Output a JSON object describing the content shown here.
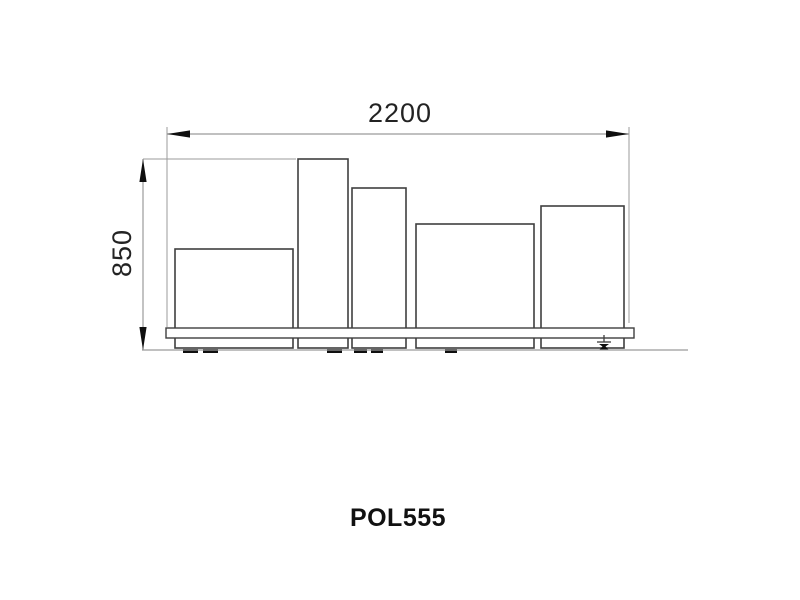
{
  "product": {
    "code": "POL555"
  },
  "dimensions": {
    "width": {
      "label": "2200"
    },
    "height": {
      "label": "850"
    }
  },
  "colors": {
    "background": "#ffffff",
    "dim_line": "#9b9b9b",
    "outline": "#3f3f3f",
    "arrow": "#0f0f0f",
    "dim_text": "#232323",
    "code_text": "#111111"
  },
  "geometry": {
    "modules": [
      {
        "x": 175,
        "y": 249,
        "w": 118,
        "h": 99
      },
      {
        "x": 298,
        "y": 159,
        "w": 50,
        "h": 189
      },
      {
        "x": 352,
        "y": 188,
        "w": 54,
        "h": 160
      },
      {
        "x": 416,
        "y": 224,
        "w": 118,
        "h": 124
      },
      {
        "x": 541,
        "y": 206,
        "w": 83,
        "h": 142
      }
    ],
    "plinth": {
      "x": 166,
      "y": 328,
      "w": 468,
      "h": 10
    },
    "ground": {
      "x1": 142,
      "x2": 688,
      "y": 350
    },
    "feet": [
      {
        "x": 183,
        "w": 15
      },
      {
        "x": 203,
        "w": 15
      },
      {
        "x": 327,
        "w": 15
      },
      {
        "x": 354,
        "w": 13
      },
      {
        "x": 371,
        "w": 12
      },
      {
        "x": 445,
        "w": 12
      }
    ],
    "leveler": {
      "cx": 604
    }
  }
}
